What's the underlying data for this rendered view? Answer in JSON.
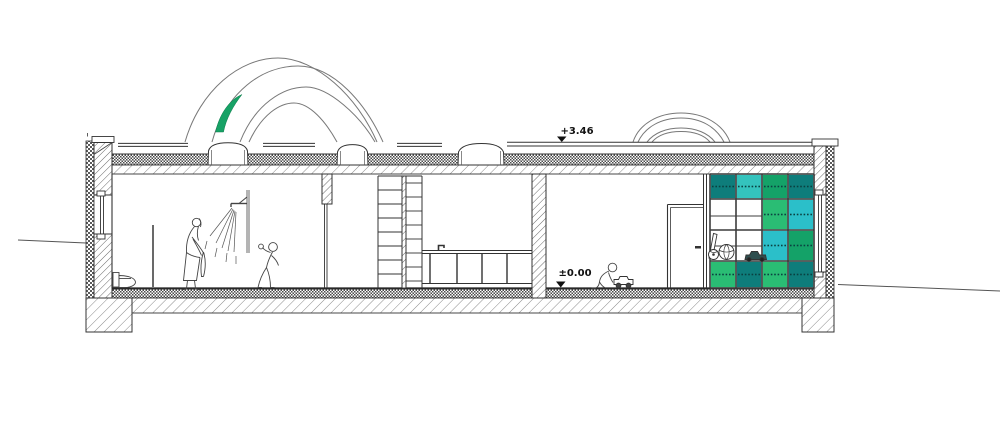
{
  "document": {
    "type": "architectural-section-drawing",
    "background": "#ffffff"
  },
  "annotations": {
    "roof_level": "+3.46",
    "floor_level": "±0.00"
  },
  "palette": {
    "line": "#333333",
    "light_line": "#777777",
    "accent_lens_green": "#17A266",
    "dots": "#0A4040",
    "shelf": {
      "teal": "#0E7D7B",
      "turquoise": "#34C3BD",
      "cyan": "#2BBFC9",
      "green": "#2ABD74",
      "deep_green": "#14A268"
    }
  },
  "shelf_unit": {
    "rows": 4,
    "columns": 4,
    "grid": [
      [
        "teal",
        "turquoise",
        "deep_green",
        "teal"
      ],
      [
        "",
        "",
        "green",
        "cyan"
      ],
      [
        "",
        "",
        "cyan",
        "deep_green"
      ],
      [
        "green",
        "teal",
        "green",
        "teal"
      ]
    ]
  }
}
